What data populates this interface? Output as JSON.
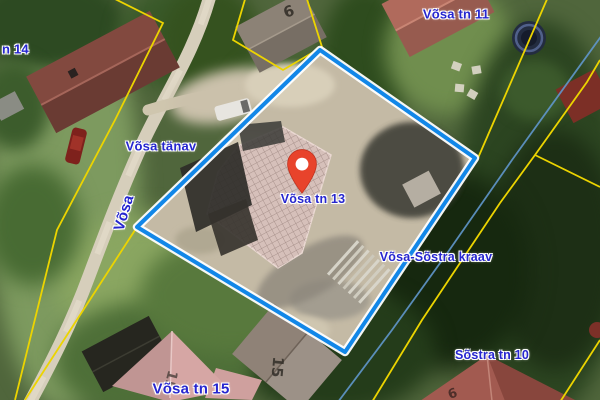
{
  "map": {
    "type": "aerial-cadastral-view",
    "colors": {
      "parcel_boundary": "#1287e8",
      "boundary_casing": "#ffffff",
      "cadastral_line": "#ecd400",
      "watercourse": "#6097cc",
      "label_text": "#2626cf",
      "marker_fill": "#e8432b",
      "marker_stroke": "#c0321f",
      "road_fill": "#d6cebb"
    },
    "marker": {
      "name": "location-marker",
      "x": 302,
      "y": 193
    },
    "labels": [
      {
        "name": "label-vosa-tn-14",
        "text": "n 14",
        "x": 2,
        "y": 49,
        "size": 13,
        "rotate": 0,
        "align": "left"
      },
      {
        "name": "label-vosa-tn-11",
        "text": "Võsa tn 11",
        "x": 456,
        "y": 14,
        "size": 13,
        "rotate": 0
      },
      {
        "name": "label-vosa-tanav",
        "text": "Võsa tänav",
        "x": 161,
        "y": 146,
        "size": 13,
        "rotate": 0
      },
      {
        "name": "label-vosa-street",
        "text": "Võsa",
        "x": 124,
        "y": 213,
        "size": 15,
        "rotate": -73
      },
      {
        "name": "label-vosa-tn-13",
        "text": "Võsa tn 13",
        "x": 313,
        "y": 199,
        "size": 12.5,
        "rotate": 0
      },
      {
        "name": "label-vosa-sostra-kraav",
        "text": "Võsa-Sõstra kraav",
        "x": 436,
        "y": 257,
        "size": 12.5,
        "rotate": 0
      },
      {
        "name": "label-sostra-tn-10",
        "text": "Sõstra tn 10",
        "x": 492,
        "y": 355,
        "size": 12.5,
        "rotate": 0
      },
      {
        "name": "label-vosa-tn-15",
        "text": "Võsa tn 15",
        "x": 191,
        "y": 389,
        "size": 15,
        "rotate": 0
      }
    ],
    "roof_numbers": [
      {
        "name": "roof-number-6",
        "text": "6",
        "x": 289,
        "y": 12,
        "size": 15,
        "rotate": -20,
        "color": "#2f2a24",
        "opacity": 0.85
      },
      {
        "name": "roof-number-15-pink-house",
        "text": "15",
        "x": 170,
        "y": 380,
        "size": 14,
        "rotate": 105,
        "color": "#4a3f3a",
        "opacity": 0.8
      },
      {
        "name": "roof-number-15-gray-building",
        "text": "15",
        "x": 277,
        "y": 367,
        "size": 15,
        "rotate": 95,
        "color": "#322e28",
        "opacity": 0.85
      },
      {
        "name": "roof-number-9",
        "text": "9",
        "x": 452,
        "y": 392,
        "size": 13,
        "rotate": 160,
        "color": "#3a2420",
        "opacity": 0.8
      }
    ]
  }
}
